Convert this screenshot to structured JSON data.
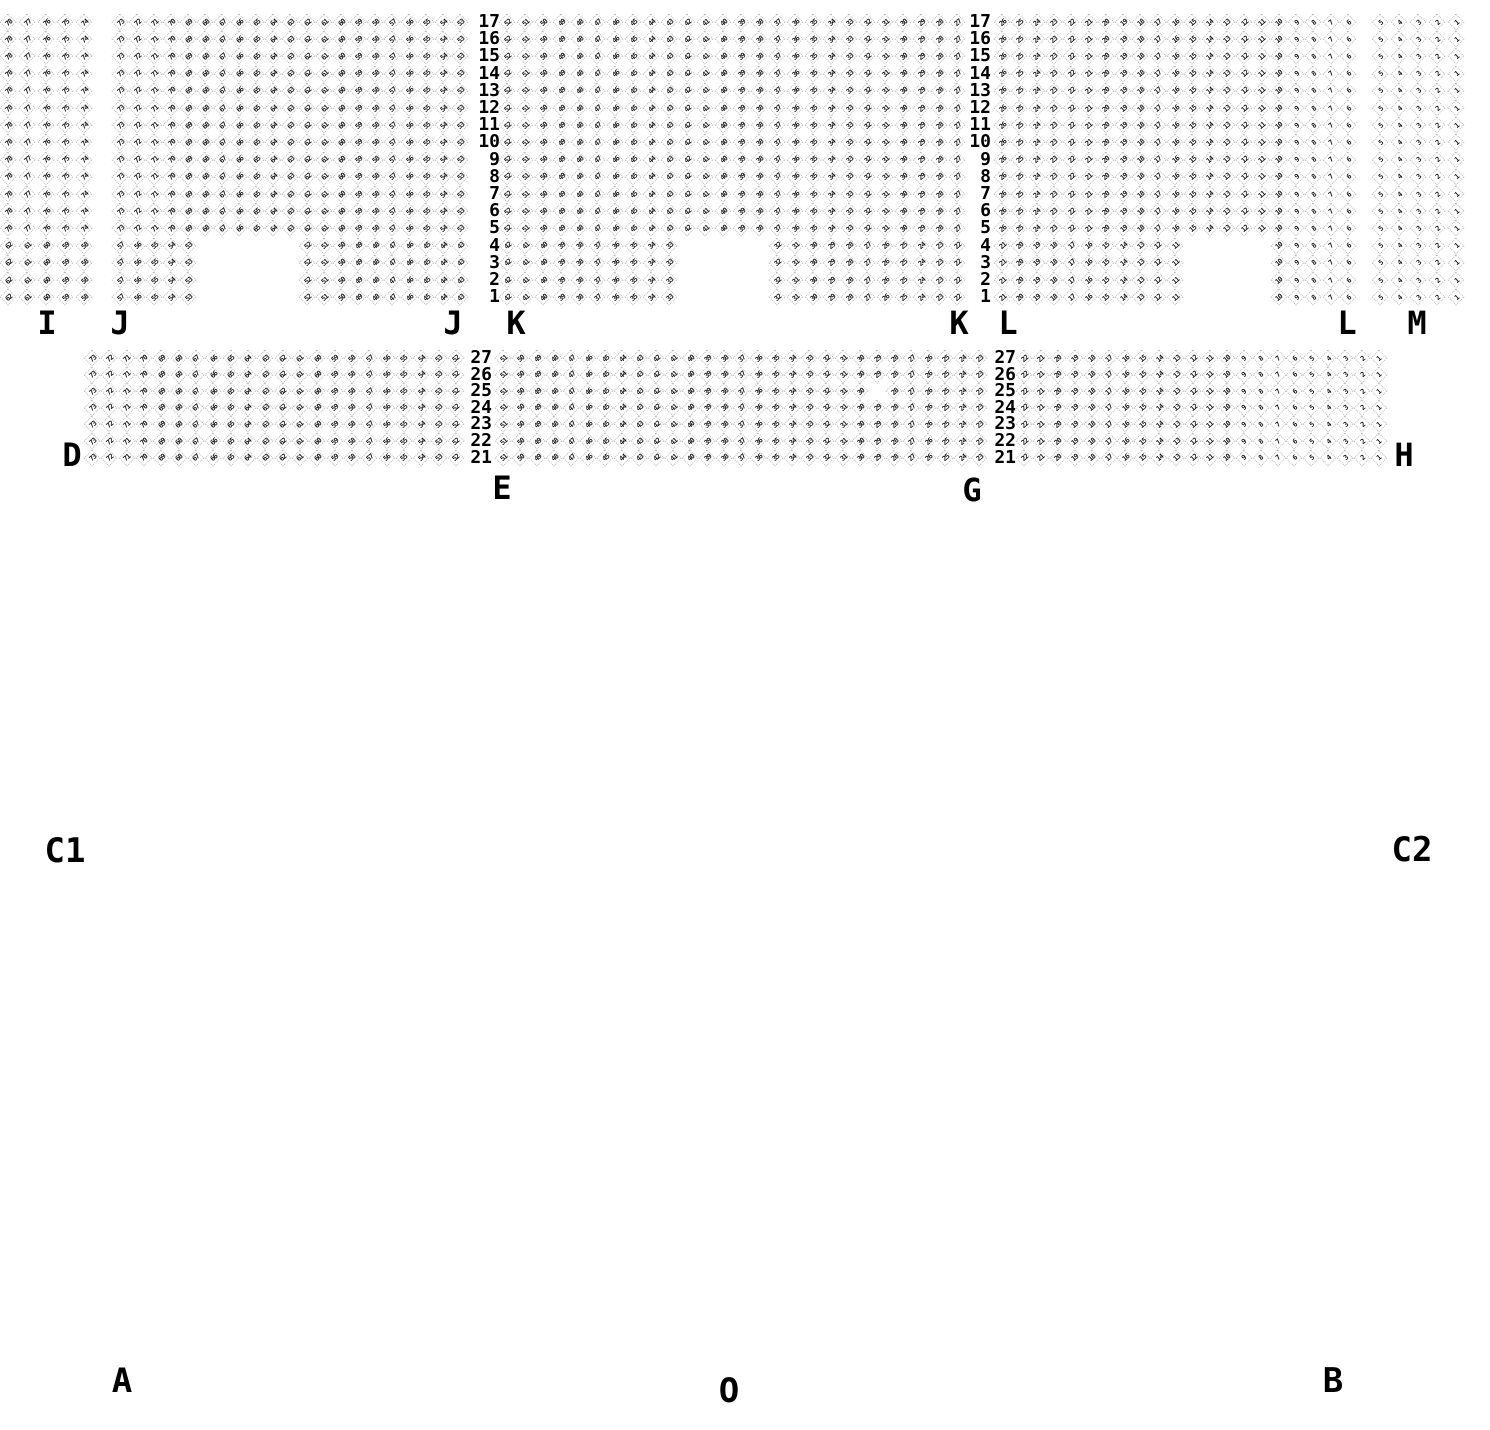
{
  "seat_style": {
    "outline_color": "#bdbdbd",
    "number_color": "#1c1c1c",
    "label_color": "#000000"
  },
  "upper_band": {
    "row_numbers_top_to_bottom": [
      "17",
      "16",
      "15",
      "14",
      "13",
      "12",
      "11",
      "10",
      "9",
      "8",
      "7",
      "6",
      "5",
      "4",
      "3",
      "2",
      "1"
    ],
    "short_row_numbers": [
      "4",
      "3",
      "2",
      "1"
    ],
    "geometry": {
      "y_first_row": 22,
      "row_dy": 17.2,
      "seat_size": 15
    },
    "row_label_columns": [
      {
        "x_right": 500
      },
      {
        "x_right": 991
      }
    ],
    "sections": [
      {
        "label": "I",
        "x_first": 8,
        "dx": 19.0,
        "cols": 5,
        "first_seat_number": 78,
        "short": {
          "left_cols": 5,
          "left_first": 62,
          "gap_cols": 0,
          "right_cols": 0,
          "right_first": 0
        }
      },
      {
        "label": "J",
        "x_first": 120,
        "dx": 17.0,
        "cols": 21,
        "first_seat_number": 73,
        "short": {
          "left_cols": 5,
          "left_first": 57,
          "gap_cols": 6,
          "right_cols": 10,
          "right_first": 52
        }
      },
      {
        "label": "K",
        "x_first": 507,
        "dx": 18.0,
        "cols": 26,
        "first_seat_number": 52,
        "short": {
          "left_cols": 10,
          "left_first": 42,
          "gap_cols": 5,
          "right_cols": 11,
          "right_first": 32
        }
      },
      {
        "label": "L",
        "x_first": 1002,
        "dx": 17.3,
        "cols": 21,
        "first_seat_number": 26,
        "short": {
          "left_cols": 11,
          "left_first": 21,
          "gap_cols": 5,
          "right_cols": 5,
          "right_first": 10
        }
      },
      {
        "label": "M",
        "x_first": 1380,
        "dx": 19.0,
        "cols": 5,
        "first_seat_number": 5,
        "short": {
          "left_cols": 5,
          "left_first": 5,
          "gap_cols": 0,
          "right_cols": 0,
          "right_first": 0
        }
      }
    ],
    "section_labels": [
      {
        "text": "I",
        "x": 47,
        "y": 323
      },
      {
        "text": "J",
        "x": 120,
        "y": 323
      },
      {
        "text": "J",
        "x": 453,
        "y": 323
      },
      {
        "text": "K",
        "x": 516,
        "y": 323
      },
      {
        "text": "K",
        "x": 959,
        "y": 323
      },
      {
        "text": "L",
        "x": 1008,
        "y": 323
      },
      {
        "text": "L",
        "x": 1347,
        "y": 323
      },
      {
        "text": "M",
        "x": 1417,
        "y": 323
      }
    ]
  },
  "lower_band": {
    "row_numbers_top_to_bottom": [
      "27",
      "26",
      "25",
      "24",
      "23",
      "22",
      "21"
    ],
    "geometry": {
      "y_first_row": 358,
      "row_dy": 16.6,
      "seat_size": 15
    },
    "row_label_columns": [
      {
        "x_right": 492
      },
      {
        "x_right": 1016
      }
    ],
    "sections": [
      {
        "label": "D",
        "x_first": 92,
        "dx": 17.33,
        "cols": 22,
        "first_seat_number": 73
      },
      {
        "label": "E",
        "x_first": 503,
        "dx": 17.0,
        "cols": 29,
        "first_seat_number": 51
      },
      {
        "label": "G",
        "x_first": 1024,
        "dx": 16.9,
        "cols": 22,
        "first_seat_number": 22
      }
    ],
    "missing_seats": [
      {
        "section": "E",
        "row": "25",
        "col_index": 22
      }
    ],
    "section_labels": [
      {
        "text": "D",
        "x": 72,
        "y": 455
      },
      {
        "text": "E",
        "x": 502,
        "y": 488
      },
      {
        "text": "G",
        "x": 972,
        "y": 490
      },
      {
        "text": "H",
        "x": 1404,
        "y": 455
      }
    ]
  },
  "area_labels": [
    {
      "text": "C1",
      "x": 65,
      "y": 851
    },
    {
      "text": "C2",
      "x": 1412,
      "y": 850
    },
    {
      "text": "A",
      "x": 122,
      "y": 1381
    },
    {
      "text": "O",
      "x": 729,
      "y": 1391
    },
    {
      "text": "B",
      "x": 1333,
      "y": 1381
    }
  ]
}
